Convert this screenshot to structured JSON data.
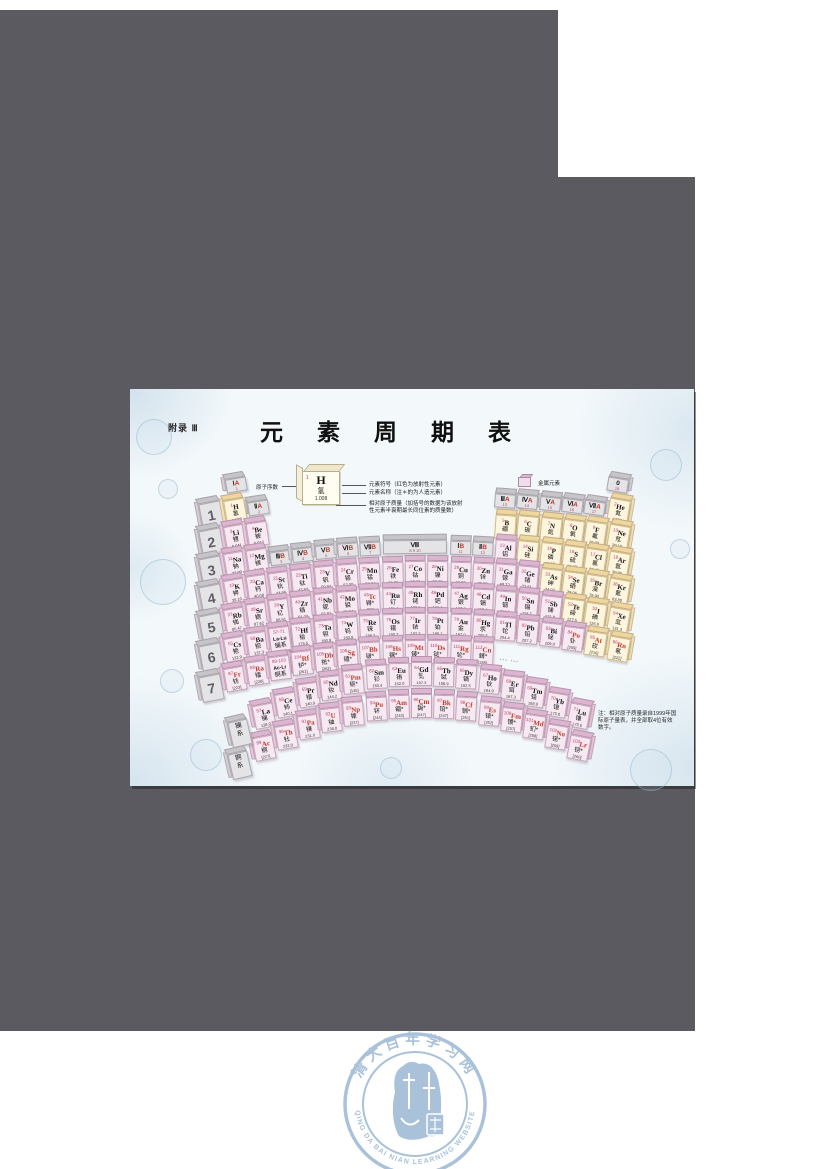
{
  "page": {
    "appendix_label": "附录 Ⅲ",
    "title": "元 素 周 期 表"
  },
  "legend": {
    "atomic_number_label": "原子序数",
    "sample": {
      "number": "1",
      "symbol": "H",
      "name": "氢",
      "mass": "1.008"
    },
    "callout_symbol": "元素符号（红色为放射性元素）",
    "callout_name": "元素名称（注＊的为人造元素）",
    "callout_mass": "相对原子质量（加括号的数据为该放射性元素半衰期最长同位素的质量数）",
    "categories": [
      {
        "label": "金属元素",
        "color": "#dcb6d0"
      },
      {
        "label": "非金属元素",
        "color": "#eed79b"
      }
    ]
  },
  "note": {
    "text": "注：相对原子质量录自1999年国际原子量表，并全部取4位有效数字。"
  },
  "ellipsis": "……",
  "period_labels": [
    "1",
    "2",
    "3",
    "4",
    "5",
    "6",
    "7"
  ],
  "series_labels": [
    {
      "zh": "镧系"
    },
    {
      "zh": "锕系"
    }
  ],
  "groups": [
    {
      "roman": "Ⅰ",
      "suffix": "A",
      "num": "1",
      "col": 1,
      "top_period": 1
    },
    {
      "roman": "Ⅱ",
      "suffix": "A",
      "num": "2",
      "col": 2,
      "top_period": 2
    },
    {
      "roman": "Ⅲ",
      "suffix": "B",
      "num": "3",
      "col": 3,
      "top_period": 4
    },
    {
      "roman": "Ⅳ",
      "suffix": "B",
      "num": "4",
      "col": 4,
      "top_period": 4
    },
    {
      "roman": "Ⅴ",
      "suffix": "B",
      "num": "5",
      "col": 5,
      "top_period": 4
    },
    {
      "roman": "Ⅵ",
      "suffix": "B",
      "num": "6",
      "col": 6,
      "top_period": 4
    },
    {
      "roman": "Ⅶ",
      "suffix": "B",
      "num": "7",
      "col": 7,
      "top_period": 4
    },
    {
      "roman": "Ⅷ",
      "suffix": "",
      "num": "8 9 10",
      "col": 9,
      "span": 3,
      "top_period": 4
    },
    {
      "roman": "Ⅰ",
      "suffix": "B",
      "num": "11",
      "col": 11,
      "top_period": 4
    },
    {
      "roman": "Ⅱ",
      "suffix": "B",
      "num": "12",
      "col": 12,
      "top_period": 4
    },
    {
      "roman": "Ⅲ",
      "suffix": "A",
      "num": "13",
      "col": 13,
      "top_period": 2
    },
    {
      "roman": "Ⅳ",
      "suffix": "A",
      "num": "14",
      "col": 14,
      "top_period": 2
    },
    {
      "roman": "Ⅴ",
      "suffix": "A",
      "num": "15",
      "col": 15,
      "top_period": 2
    },
    {
      "roman": "Ⅵ",
      "suffix": "A",
      "num": "16",
      "col": 16,
      "top_period": 2
    },
    {
      "roman": "Ⅶ",
      "suffix": "A",
      "num": "17",
      "col": 17,
      "top_period": 2
    },
    {
      "roman": "0",
      "suffix": "",
      "num": "18",
      "col": 18,
      "top_period": 1
    }
  ],
  "elements": {
    "periods": [
      {
        "period": 1,
        "items": [
          [
            1,
            "H",
            "氢",
            "1.008",
            "n",
            0,
            0,
            1
          ],
          [
            2,
            "He",
            "氦",
            "4.003",
            "n",
            0,
            0,
            18
          ]
        ]
      },
      {
        "period": 2,
        "items": [
          [
            3,
            "Li",
            "锂",
            "6.941",
            "m",
            0,
            0,
            1
          ],
          [
            4,
            "Be",
            "铍",
            "9.012",
            "m",
            0,
            0,
            2
          ],
          [
            5,
            "B",
            "硼",
            "10.81",
            "n",
            0,
            0,
            13
          ],
          [
            6,
            "C",
            "碳",
            "12.01",
            "n",
            0,
            0,
            14
          ],
          [
            7,
            "N",
            "氮",
            "14.01",
            "n",
            0,
            0,
            15
          ],
          [
            8,
            "O",
            "氧",
            "16.00",
            "n",
            0,
            0,
            16
          ],
          [
            9,
            "F",
            "氟",
            "19.00",
            "n",
            0,
            0,
            17
          ],
          [
            10,
            "Ne",
            "氖",
            "20.18",
            "n",
            0,
            0,
            18
          ]
        ]
      },
      {
        "period": 3,
        "items": [
          [
            11,
            "Na",
            "钠",
            "22.99",
            "m",
            0,
            0,
            1
          ],
          [
            12,
            "Mg",
            "镁",
            "24.31",
            "m",
            0,
            0,
            2
          ],
          [
            13,
            "Al",
            "铝",
            "26.98",
            "m",
            0,
            0,
            13
          ],
          [
            14,
            "Si",
            "硅",
            "28.09",
            "n",
            0,
            0,
            14
          ],
          [
            15,
            "P",
            "磷",
            "30.97",
            "n",
            0,
            0,
            15
          ],
          [
            16,
            "S",
            "硫",
            "32.07",
            "n",
            0,
            0,
            16
          ],
          [
            17,
            "Cl",
            "氯",
            "35.45",
            "n",
            0,
            0,
            17
          ],
          [
            18,
            "Ar",
            "氩",
            "39.95",
            "n",
            0,
            0,
            18
          ]
        ]
      },
      {
        "period": 4,
        "items": [
          [
            19,
            "K",
            "钾",
            "39.10",
            "m",
            0,
            0,
            1
          ],
          [
            20,
            "Ca",
            "钙",
            "40.08",
            "m",
            0,
            0,
            2
          ],
          [
            21,
            "Sc",
            "钪",
            "44.96",
            "m",
            0,
            0,
            3
          ],
          [
            22,
            "Ti",
            "钛",
            "47.87",
            "m",
            0,
            0,
            4
          ],
          [
            23,
            "V",
            "钒",
            "50.94",
            "m",
            0,
            0,
            5
          ],
          [
            24,
            "Cr",
            "铬",
            "52.00",
            "m",
            0,
            0,
            6
          ],
          [
            25,
            "Mn",
            "锰",
            "54.94",
            "m",
            0,
            0,
            7
          ],
          [
            26,
            "Fe",
            "铁",
            "55.85",
            "m",
            0,
            0,
            8
          ],
          [
            27,
            "Co",
            "钴",
            "58.93",
            "m",
            0,
            0,
            9
          ],
          [
            28,
            "Ni",
            "镍",
            "58.69",
            "m",
            0,
            0,
            10
          ],
          [
            29,
            "Cu",
            "铜",
            "63.55",
            "m",
            0,
            0,
            11
          ],
          [
            30,
            "Zn",
            "锌",
            "65.39",
            "m",
            0,
            0,
            12
          ],
          [
            31,
            "Ga",
            "镓",
            "69.72",
            "m",
            0,
            0,
            13
          ],
          [
            32,
            "Ge",
            "锗",
            "72.61",
            "m",
            0,
            0,
            14
          ],
          [
            33,
            "As",
            "砷",
            "74.92",
            "n",
            0,
            0,
            15
          ],
          [
            34,
            "Se",
            "硒",
            "78.96",
            "n",
            0,
            0,
            16
          ],
          [
            35,
            "Br",
            "溴",
            "79.90",
            "n",
            0,
            0,
            17
          ],
          [
            36,
            "Kr",
            "氪",
            "83.80",
            "n",
            0,
            0,
            18
          ]
        ]
      },
      {
        "period": 5,
        "items": [
          [
            37,
            "Rb",
            "铷",
            "85.47",
            "m",
            0,
            0,
            1
          ],
          [
            38,
            "Sr",
            "锶",
            "87.62",
            "m",
            0,
            0,
            2
          ],
          [
            39,
            "Y",
            "钇",
            "88.91",
            "m",
            0,
            0,
            3
          ],
          [
            40,
            "Zr",
            "锆",
            "91.22",
            "m",
            0,
            0,
            4
          ],
          [
            41,
            "Nb",
            "铌",
            "92.91",
            "m",
            0,
            0,
            5
          ],
          [
            42,
            "Mo",
            "钼",
            "95.94",
            "m",
            0,
            0,
            6
          ],
          [
            43,
            "Tc",
            "锝",
            "[98]",
            "m",
            1,
            1,
            7
          ],
          [
            44,
            "Ru",
            "钌",
            "101.1",
            "m",
            0,
            0,
            8
          ],
          [
            45,
            "Rh",
            "铑",
            "102.9",
            "m",
            0,
            0,
            9
          ],
          [
            46,
            "Pd",
            "钯",
            "106.4",
            "m",
            0,
            0,
            10
          ],
          [
            47,
            "Ag",
            "银",
            "107.9",
            "m",
            0,
            0,
            11
          ],
          [
            48,
            "Cd",
            "镉",
            "112.4",
            "m",
            0,
            0,
            12
          ],
          [
            49,
            "In",
            "铟",
            "114.8",
            "m",
            0,
            0,
            13
          ],
          [
            50,
            "Sn",
            "锡",
            "118.7",
            "m",
            0,
            0,
            14
          ],
          [
            51,
            "Sb",
            "锑",
            "121.8",
            "m",
            0,
            0,
            15
          ],
          [
            52,
            "Te",
            "碲",
            "127.6",
            "n",
            0,
            0,
            16
          ],
          [
            53,
            "I",
            "碘",
            "126.9",
            "n",
            0,
            0,
            17
          ],
          [
            54,
            "Xe",
            "氙",
            "131.3",
            "n",
            0,
            0,
            18
          ]
        ]
      },
      {
        "period": 6,
        "items": [
          [
            55,
            "Cs",
            "铯",
            "132.9",
            "m",
            0,
            0,
            1
          ],
          [
            56,
            "Ba",
            "钡",
            "137.3",
            "m",
            0,
            0,
            2
          ],
          [
            72,
            "Hf",
            "铪",
            "178.5",
            "m",
            0,
            0,
            4
          ],
          [
            73,
            "Ta",
            "钽",
            "180.9",
            "m",
            0,
            0,
            5
          ],
          [
            74,
            "W",
            "钨",
            "183.8",
            "m",
            0,
            0,
            6
          ],
          [
            75,
            "Re",
            "铼",
            "186.2",
            "m",
            0,
            0,
            7
          ],
          [
            76,
            "Os",
            "锇",
            "190.2",
            "m",
            0,
            0,
            8
          ],
          [
            77,
            "Ir",
            "铱",
            "192.2",
            "m",
            0,
            0,
            9
          ],
          [
            78,
            "Pt",
            "铂",
            "195.1",
            "m",
            0,
            0,
            10
          ],
          [
            79,
            "Au",
            "金",
            "197.0",
            "m",
            0,
            0,
            11
          ],
          [
            80,
            "Hg",
            "汞",
            "200.6",
            "m",
            0,
            0,
            12
          ],
          [
            81,
            "Tl",
            "铊",
            "204.4",
            "m",
            0,
            0,
            13
          ],
          [
            82,
            "Pb",
            "铅",
            "207.2",
            "m",
            0,
            0,
            14
          ],
          [
            83,
            "Bi",
            "铋",
            "209.0",
            "m",
            0,
            0,
            15
          ],
          [
            84,
            "Po",
            "钋",
            "[209]",
            "m",
            1,
            0,
            16
          ],
          [
            85,
            "At",
            "砹",
            "[210]",
            "n",
            1,
            0,
            17
          ],
          [
            86,
            "Rn",
            "氡",
            "[222]",
            "n",
            1,
            0,
            18
          ]
        ]
      },
      {
        "period": 7,
        "items": [
          [
            87,
            "Fr",
            "钫",
            "[223]",
            "m",
            1,
            0,
            1
          ],
          [
            88,
            "Ra",
            "镭",
            "[226]",
            "m",
            1,
            0,
            2
          ],
          [
            104,
            "Rf",
            "𬬻",
            "[261]",
            "m",
            1,
            1,
            4
          ],
          [
            105,
            "Db",
            "𬭊",
            "[262]",
            "m",
            1,
            1,
            5
          ],
          [
            106,
            "Sg",
            "𬭳",
            "[266]",
            "m",
            1,
            1,
            6
          ],
          [
            107,
            "Bh",
            "𬭛",
            "[264]",
            "m",
            1,
            1,
            7
          ],
          [
            108,
            "Hs",
            "𬭶",
            "[277]",
            "m",
            1,
            1,
            8
          ],
          [
            109,
            "Mt",
            "鿏",
            "[268]",
            "m",
            1,
            1,
            9
          ],
          [
            110,
            "Ds",
            "𫟼",
            "[281]",
            "m",
            1,
            1,
            10
          ],
          [
            111,
            "Rg",
            "𬬭",
            "[272]",
            "m",
            1,
            1,
            11
          ],
          [
            112,
            "Cn",
            "鎶",
            "[285]",
            "m",
            1,
            1,
            12
          ]
        ]
      }
    ],
    "placeholders": [
      {
        "range": "57-71",
        "syms": "La-Lu",
        "zh": "镧系",
        "period": 6,
        "col": 3
      },
      {
        "range": "89-103",
        "syms": "Ac-Lr",
        "zh": "锕系",
        "period": 7,
        "col": 3
      }
    ],
    "lanthanides": [
      [
        57,
        "La",
        "镧",
        "138.9",
        0,
        0
      ],
      [
        58,
        "Ce",
        "铈",
        "140.1",
        0,
        0
      ],
      [
        59,
        "Pr",
        "镨",
        "140.9",
        0,
        0
      ],
      [
        60,
        "Nd",
        "钕",
        "144.2",
        0,
        0
      ],
      [
        61,
        "Pm",
        "钷",
        "[145]",
        1,
        1
      ],
      [
        62,
        "Sm",
        "钐",
        "150.4",
        0,
        0
      ],
      [
        63,
        "Eu",
        "铕",
        "152.0",
        0,
        0
      ],
      [
        64,
        "Gd",
        "钆",
        "157.3",
        0,
        0
      ],
      [
        65,
        "Tb",
        "铽",
        "158.9",
        0,
        0
      ],
      [
        66,
        "Dy",
        "镝",
        "162.5",
        0,
        0
      ],
      [
        67,
        "Ho",
        "钬",
        "164.9",
        0,
        0
      ],
      [
        68,
        "Er",
        "铒",
        "167.3",
        0,
        0
      ],
      [
        69,
        "Tm",
        "铥",
        "168.9",
        0,
        0
      ],
      [
        70,
        "Yb",
        "镱",
        "173.0",
        0,
        0
      ],
      [
        71,
        "Lu",
        "镥",
        "175.0",
        0,
        0
      ]
    ],
    "actinides": [
      [
        89,
        "Ac",
        "锕",
        "[227]",
        1,
        0
      ],
      [
        90,
        "Th",
        "钍",
        "232.0",
        1,
        0
      ],
      [
        91,
        "Pa",
        "镤",
        "231.0",
        1,
        0
      ],
      [
        92,
        "U",
        "铀",
        "238.0",
        1,
        0
      ],
      [
        93,
        "Np",
        "镎",
        "[237]",
        1,
        0
      ],
      [
        94,
        "Pu",
        "钚",
        "[244]",
        1,
        0
      ],
      [
        95,
        "Am",
        "镅",
        "[243]",
        1,
        1
      ],
      [
        96,
        "Cm",
        "锔",
        "[247]",
        1,
        1
      ],
      [
        97,
        "Bk",
        "锫",
        "[247]",
        1,
        1
      ],
      [
        98,
        "Cf",
        "锎",
        "[251]",
        1,
        1
      ],
      [
        99,
        "Es",
        "锿",
        "[252]",
        1,
        1
      ],
      [
        100,
        "Fm",
        "镄",
        "[257]",
        1,
        1
      ],
      [
        101,
        "Md",
        "钔",
        "[258]",
        1,
        1
      ],
      [
        102,
        "No",
        "锘",
        "[259]",
        1,
        1
      ],
      [
        103,
        "Lr",
        "铹",
        "[260]",
        1,
        1
      ]
    ]
  },
  "watermark": {
    "zh": "清大百年学习网",
    "en": "QING DA BAI NIAN LEARNING WEBSITE",
    "color": "#a9c2da"
  },
  "colors": {
    "viewer_background": "#5a5a60",
    "metal": "#dcb6d0",
    "nonmetal": "#eed79b",
    "header_gray": "#c6c6ca",
    "radioactive_text": "#c0392b",
    "atomic_number_text": "#c03a63"
  }
}
